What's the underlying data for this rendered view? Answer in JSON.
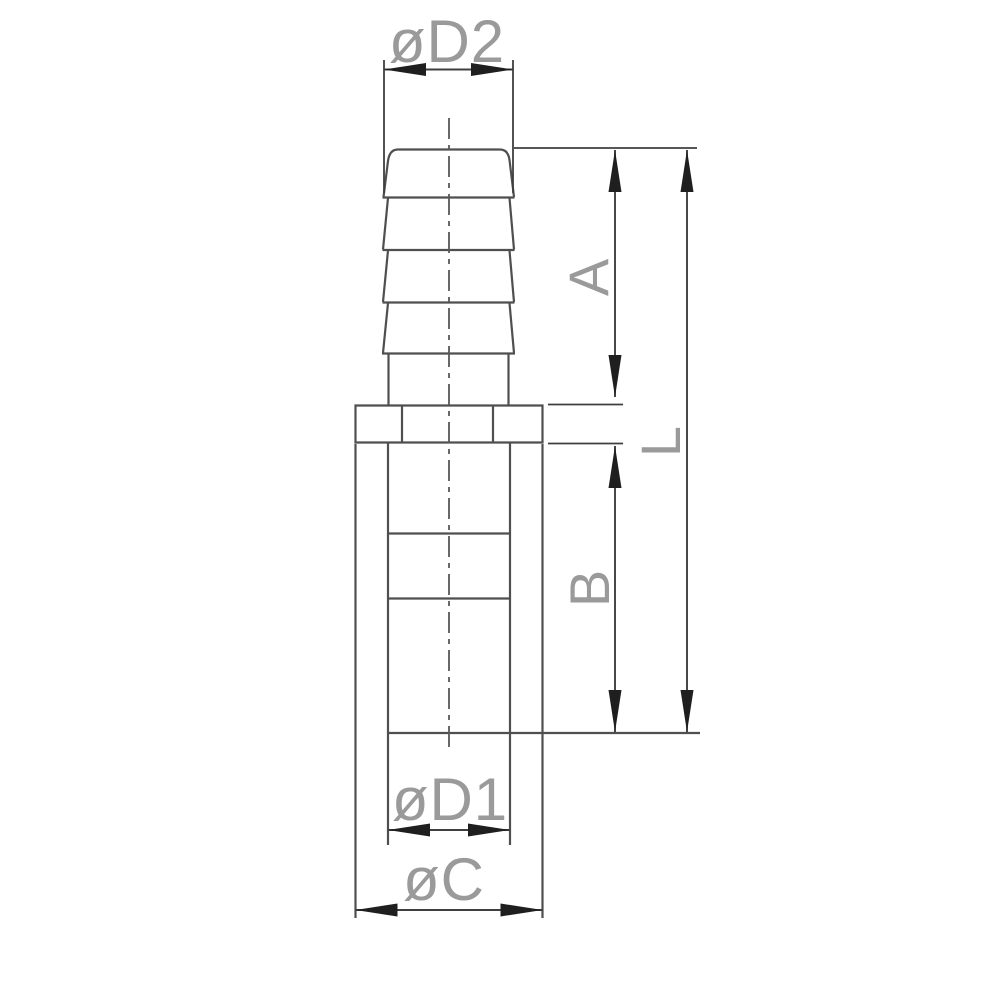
{
  "drawing": {
    "type": "technical-drawing",
    "subject": "barbed hose fitting with hex collar and socket",
    "labels": {
      "d2": "øD2",
      "a": "A",
      "l": "L",
      "b": "B",
      "d1": "øD1",
      "c": "øC"
    }
  },
  "colors": {
    "background": "#ffffff",
    "outline": "#4f4f4f",
    "dimension-line": "#3f3f3f",
    "arrow": "#1f1f1f",
    "label": "#9a9a9a",
    "centerline": "#585858"
  }
}
